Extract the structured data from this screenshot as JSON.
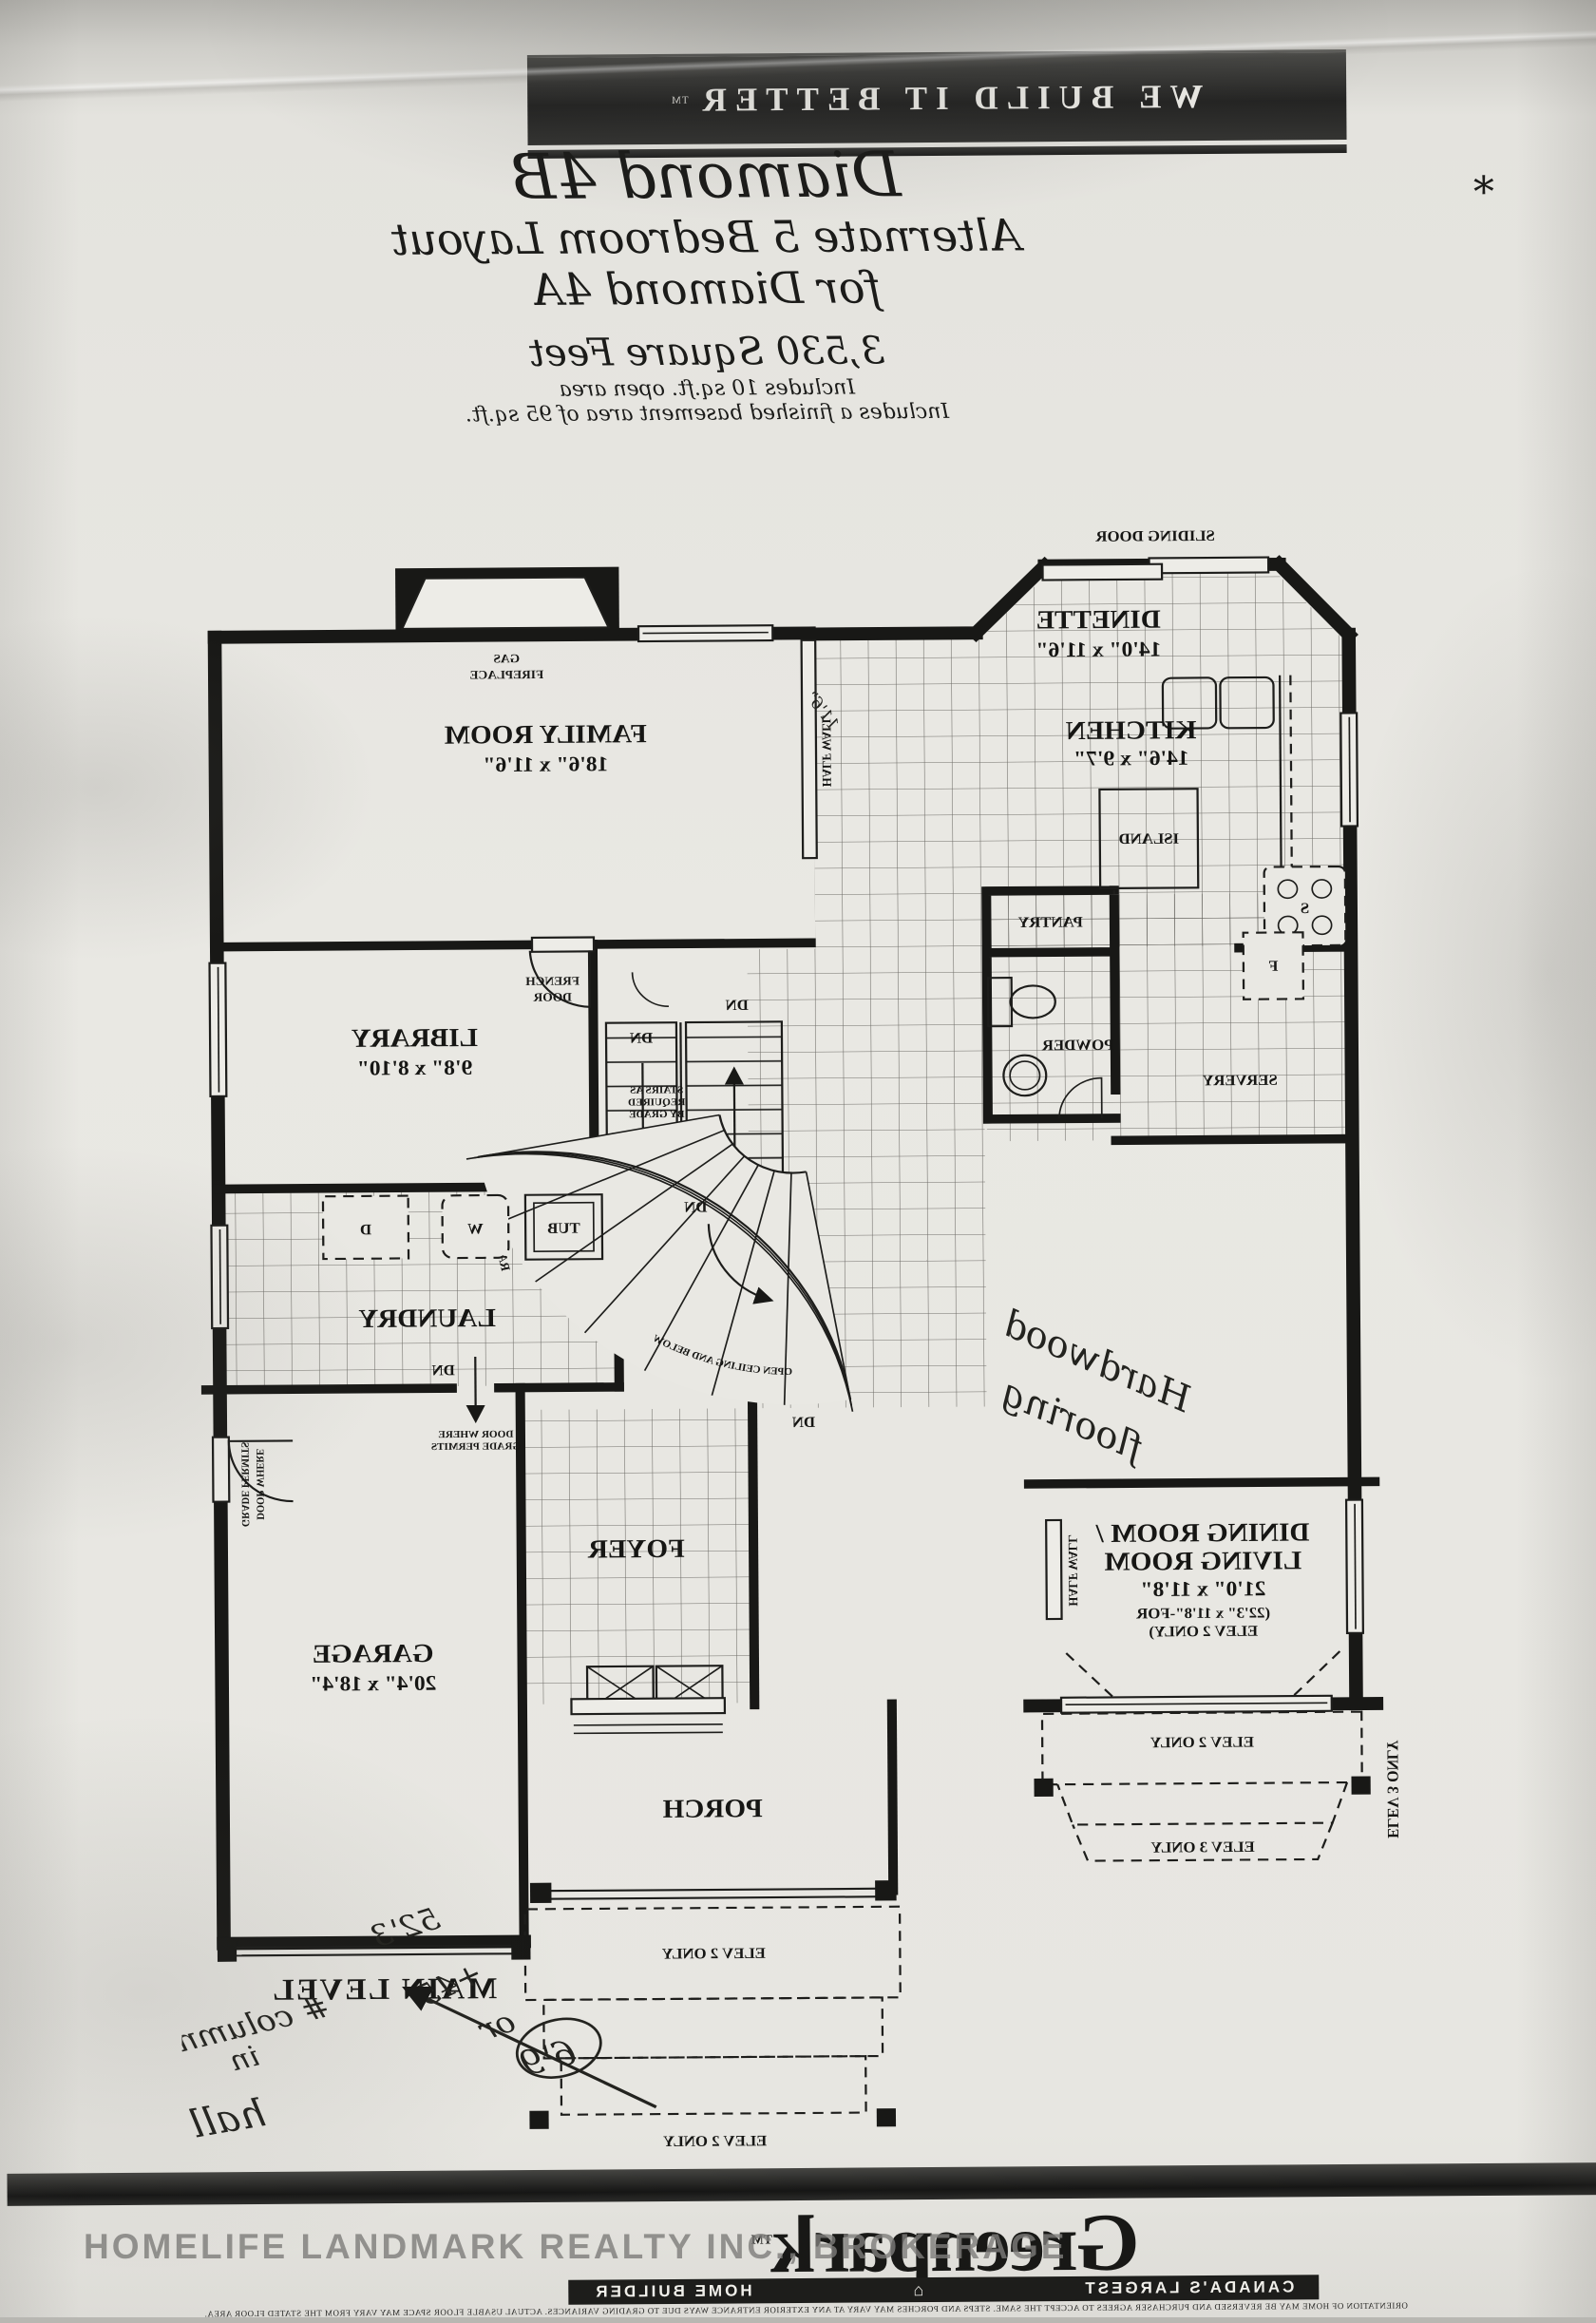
{
  "photo": {
    "watermark": "HOMELIFE LANDMARK REALTY INC., BROKERAGE",
    "asterisk": "*"
  },
  "header": {
    "banner": "WE BUILD IT BETTER",
    "banner_tm": "TM",
    "title": "Diamond 4B",
    "subtitle_line1": "Alternate 5 Bedroom Layout",
    "subtitle_line2": "for Diamond 4A",
    "area": "3,530 Square Feet",
    "note1": "Includes 10 sq.ft. open area",
    "note2": "Includes a finished basement area of 95 sq.ft."
  },
  "plan": {
    "rooms": {
      "family": {
        "n": "FAMILY ROOM",
        "d": "18'6\" x 11'6\""
      },
      "dinette": {
        "n": "DINETTE",
        "d": "14'0\" x 11'6\""
      },
      "kitchen": {
        "n": "KITCHEN",
        "d": "14'6\" x 9'7\""
      },
      "library": {
        "n": "LIBRARY",
        "d": "9'8\" x 8'10\""
      },
      "garage": {
        "n": "GARAGE",
        "d": "20'4\" x 18'4\""
      },
      "dining": {
        "l1": "DINING ROOM /",
        "l2": "LIVING ROOM",
        "d": "21'0\" x 11'8\"",
        "a1": "(22'3\" x 11'8\"-FOR",
        "a2": "ELEV 2 ONLY)"
      }
    },
    "f": {
      "sliding": "SLIDING DOOR",
      "gas1": "GAS",
      "gas2": "FIREPLACE",
      "fr1": "FRENCH",
      "fr2": "DOOR",
      "half": "HALF WALL",
      "st1": "STAIRS AS",
      "st2": "REQUIRED",
      "st3": "BY GRADE",
      "gr1": "DOOR WHERE",
      "gr2": "GRADE PERMITS",
      "rail": "RAILING",
      "open": "OPEN CEILING AND BELOW",
      "up": "UP",
      "dn": "DN",
      "f": "F",
      "s": "S",
      "w": "W",
      "d": "D",
      "tub": "TUB",
      "e2": "ELEV 2 ONLY",
      "e3": "ELEV 3 ONLY",
      "island": "ISLAND",
      "pantry": "PANTRY",
      "powder": "POWDER",
      "servery": "SERVERY",
      "laundry": "LAUNDRY",
      "foyer": "FOYER",
      "porch": "PORCH",
      "level": "MAIN LEVEL"
    },
    "hw": {
      "h1": "Hardwood",
      "h2": "flooring",
      "dim": "11'6\"",
      "m1": "52'3",
      "m2": "+45'",
      "m3": "or",
      "m4": "6'9",
      "c1": "# columns",
      "c2": "in",
      "c3": "hall wall."
    }
  },
  "footer": {
    "brand": "Greenpark",
    "brand_tm": "TM",
    "tagline_left": "CANADA'S LARGEST",
    "tagline_right": "HOME BUILDER",
    "fine_print": "ORIENTATION OF HOME MAY BE REVERSED AND PURCHASER AGREES TO ACCEPT THE SAME. STEPS AND PORCHES MAY VARY AT ANY EXTERIOR ENTRANCE WAYS DUE TO GRADING VARIANCES. ACTUAL USABLE FLOOR SPACE MAY VARY FROM THE STATED FLOOR AREA."
  }
}
